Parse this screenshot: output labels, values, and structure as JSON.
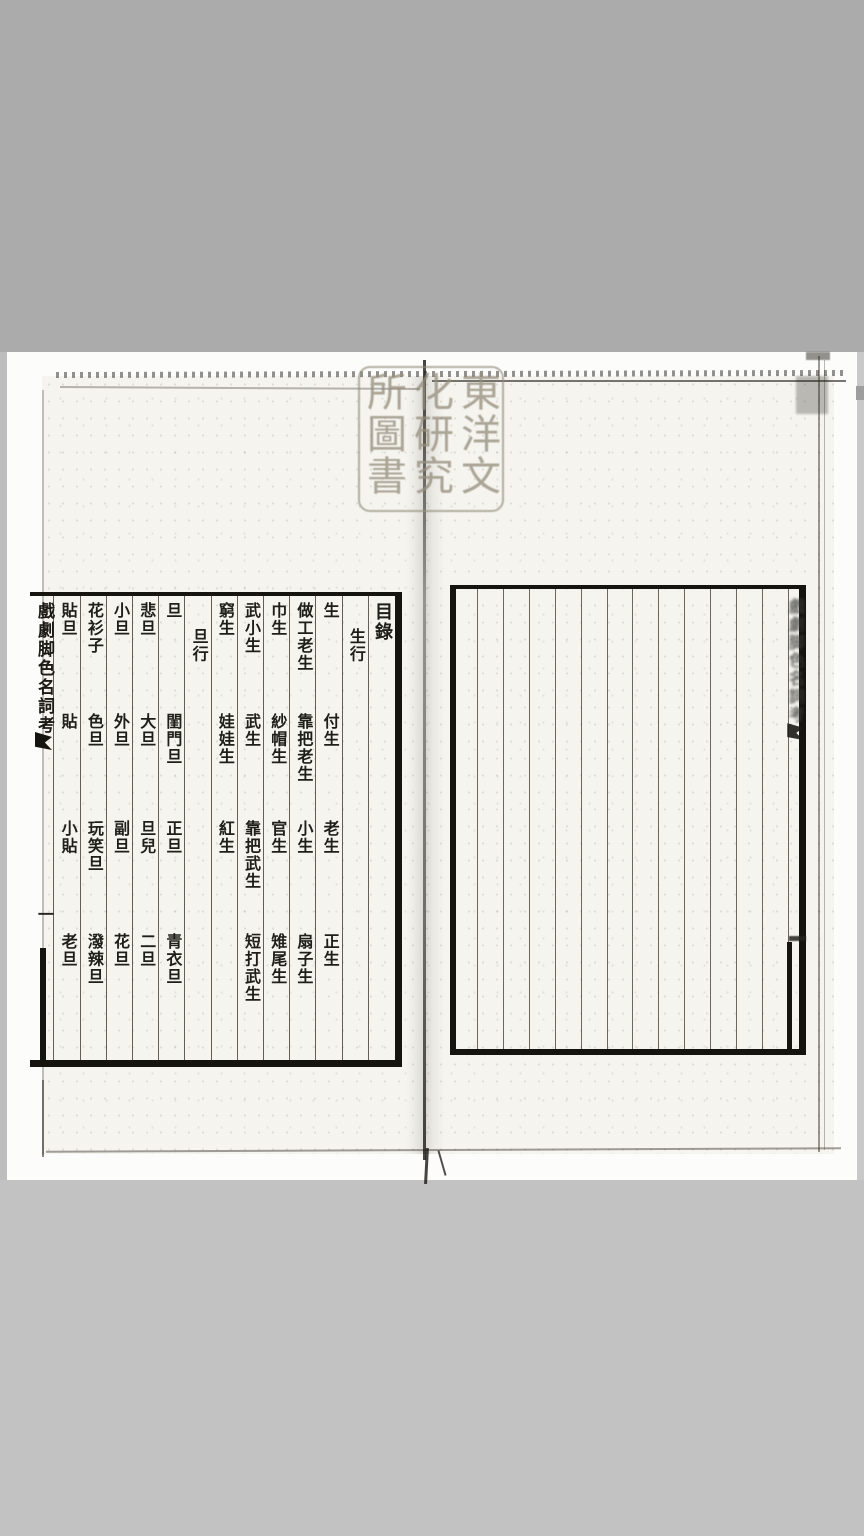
{
  "colors": {
    "mat_top": "#ababab",
    "mat_bottom": "#c2c2c2",
    "paper": "#f5f4ef",
    "ink": "#201e18",
    "seal_ink": "#968e7e"
  },
  "seal": {
    "text": "東洋文化研究所圖書"
  },
  "left_page": {
    "margin": {
      "title": "戲劇脚色名詞考",
      "page_number": "一"
    },
    "toc": {
      "columns": [
        {
          "type": "heading",
          "items": [
            {
              "row": 0,
              "text": "目錄"
            }
          ]
        },
        {
          "type": "section",
          "items": [
            {
              "row": "indent",
              "text": "生行"
            }
          ]
        },
        {
          "items": [
            {
              "row": 0,
              "text": "生"
            },
            {
              "row": 1,
              "text": "付生"
            },
            {
              "row": 2,
              "text": "老生"
            },
            {
              "row": 3,
              "text": "正生"
            }
          ]
        },
        {
          "items": [
            {
              "row": 0,
              "text": "做工老生"
            },
            {
              "row": 1,
              "text": "靠把老生"
            },
            {
              "row": 2,
              "text": "小生"
            },
            {
              "row": 3,
              "text": "扇子生"
            }
          ]
        },
        {
          "items": [
            {
              "row": 0,
              "text": "巾生"
            },
            {
              "row": 1,
              "text": "紗帽生"
            },
            {
              "row": 2,
              "text": "官生"
            },
            {
              "row": 3,
              "text": "雉尾生"
            }
          ]
        },
        {
          "items": [
            {
              "row": 0,
              "text": "武小生"
            },
            {
              "row": 1,
              "text": "武生"
            },
            {
              "row": 2,
              "text": "靠把武生"
            },
            {
              "row": 3,
              "text": "短打武生"
            }
          ]
        },
        {
          "items": [
            {
              "row": 0,
              "text": "窮生"
            },
            {
              "row": 1,
              "text": "娃娃生"
            },
            {
              "row": 2,
              "text": "紅生"
            }
          ]
        },
        {
          "type": "section",
          "items": [
            {
              "row": "indent",
              "text": "旦行"
            }
          ]
        },
        {
          "items": [
            {
              "row": 0,
              "text": "旦"
            },
            {
              "row": 1,
              "text": "閨門旦"
            },
            {
              "row": 2,
              "text": "正旦"
            },
            {
              "row": 3,
              "text": "青衣旦"
            }
          ]
        },
        {
          "items": [
            {
              "row": 0,
              "text": "悲旦"
            },
            {
              "row": 1,
              "text": "大旦"
            },
            {
              "row": 2,
              "text": "旦兒"
            },
            {
              "row": 3,
              "text": "二旦"
            }
          ]
        },
        {
          "items": [
            {
              "row": 0,
              "text": "小旦"
            },
            {
              "row": 1,
              "text": "外旦"
            },
            {
              "row": 2,
              "text": "副旦"
            },
            {
              "row": 3,
              "text": "花旦"
            }
          ]
        },
        {
          "items": [
            {
              "row": 0,
              "text": "花衫子"
            },
            {
              "row": 1,
              "text": "色旦"
            },
            {
              "row": 2,
              "text": "玩笑旦"
            },
            {
              "row": 3,
              "text": "潑辣旦"
            }
          ]
        },
        {
          "items": [
            {
              "row": 0,
              "text": "貼旦"
            },
            {
              "row": 1,
              "text": "貼"
            },
            {
              "row": 2,
              "text": "小貼"
            },
            {
              "row": 3,
              "text": "老旦"
            }
          ]
        }
      ]
    }
  },
  "right_page": {
    "ghost_title": "戲劇脚色名詞考",
    "ruled_columns": 14
  }
}
